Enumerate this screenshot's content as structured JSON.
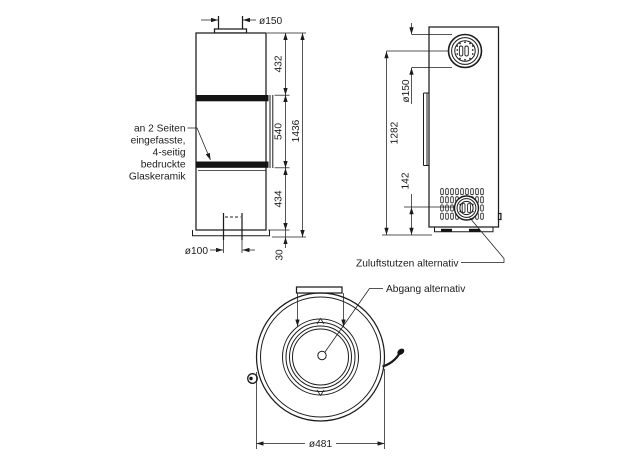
{
  "drawing": {
    "front_view": {
      "dim_flue_diameter": "ø150",
      "dim_upper_section": "432",
      "dim_glass_section": "540",
      "dim_lower_section": "434",
      "dim_base_height": "30",
      "dim_total_height": "1436",
      "dim_air_inlet_diameter": "ø100",
      "glass_note_lines": [
        "an 2 Seiten",
        "eingefasste,",
        "4-seitig",
        "bedruckte",
        "Glaskeramik"
      ]
    },
    "side_view": {
      "dim_flue_diameter": "ø150",
      "dim_flue_center_height": "1282",
      "dim_air_port_center_height": "142",
      "label_air_port": "Zuluftstutzen alternativ"
    },
    "top_view": {
      "dim_outer_diameter": "ø481",
      "label_flue_outlet": "Abgang alternativ"
    }
  }
}
